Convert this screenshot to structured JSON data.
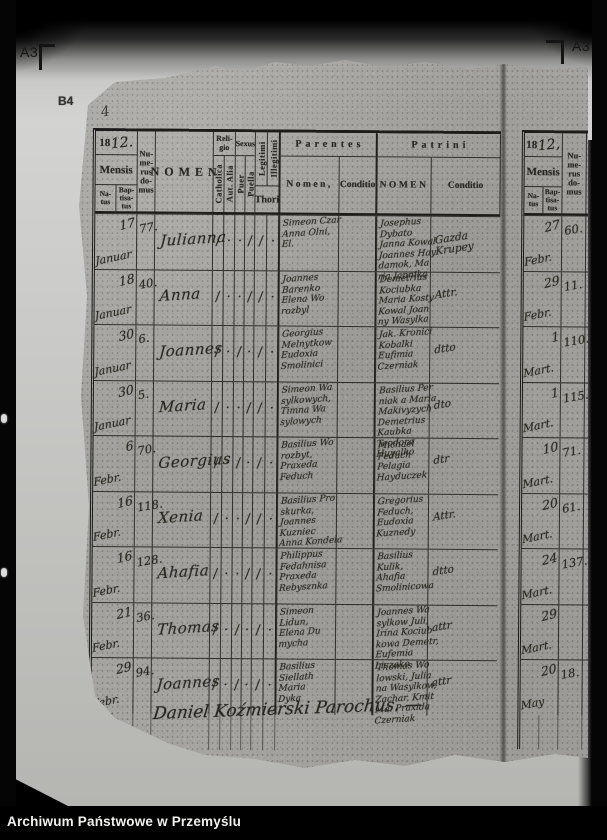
{
  "frame": {
    "label_a3_left": "A3",
    "label_a3_right": "A3",
    "label_b4": "B4",
    "pen_mark": "4",
    "archive_label": "Archiwum Państwowe w Przemyślu"
  },
  "headers": {
    "year_printed": "18",
    "year_script": "12.",
    "year_script_right": "12,",
    "mensis": "Mensis",
    "natus": "Na-\ntus",
    "baptisatus": "Bap-\ntisa-\ntus",
    "numerus_domus": "Nu-\nme-\nrus\ndo-\nmus",
    "nomen": "NOMEN",
    "nomen_partial": "N",
    "religio": "Reli-\ngio",
    "catholica": "Catholica",
    "aut_alia": "Aut. Alia",
    "sexus": "Sexus",
    "puer": "Puer",
    "puella": "Puella",
    "legitimi": "Legitimi",
    "illegitimi": "Illegitimi",
    "thori": "Thori",
    "parentes": "Parentes",
    "parentes_nomen": "Nomen,",
    "conditio": "Conditio",
    "patrini": "Patrini",
    "patrini_nomen": "NOMEN"
  },
  "register": {
    "rows": [
      {
        "day": "17",
        "month": "Januar",
        "domus": "77.",
        "name": "Julianna",
        "marks": [
          "/",
          "·",
          "·",
          "/",
          "/",
          "·"
        ],
        "parentes": "Simeon Czar\nAnna Olni,\nEl.",
        "patrini": "Josephus Dybato\nJanna Kowal\nJoannes Hay\ndamok, Ma\nria Jannika",
        "conditio": "Gazda\nKrupey"
      },
      {
        "day": "18",
        "month": "Januar",
        "domus": "40.",
        "name": "Anna",
        "marks": [
          "/",
          "·",
          "·",
          "/",
          "/",
          "·"
        ],
        "parentes": "Joannes\nBarenko\nElena Wo\nrozbyl",
        "patrini": "Demetrius\nKociubka\nMaria Kosty\nKowal Joan\nny Wasylka",
        "conditio": "Attr."
      },
      {
        "day": "30",
        "month": "Januar",
        "domus": "6.",
        "name": "Joannes",
        "marks": [
          "/",
          "·",
          "/",
          "·",
          "/",
          "·"
        ],
        "parentes": "Georgius\nMelnytkow\nEudoxia\nSmolinici",
        "patrini": "Jak. Kronici\nKobalki\nEufimia\nCzerniak",
        "conditio": "dtto"
      },
      {
        "day": "30",
        "month": "Januar",
        "domus": "5.",
        "name": "Maria",
        "marks": [
          "/",
          "·",
          "·",
          "/",
          "/",
          "·"
        ],
        "parentes": "Simeon Wa\nsylkowych,\nTimna Wa\nsylowych",
        "patrini": "Basilius Per\nniak a Maria\nMakivyzych\nDemetrius Kaubka\nTeodora Huyalko",
        "conditio": "dto"
      },
      {
        "day": "6",
        "month": "Febr.",
        "domus": "70.",
        "name": "Georgius",
        "marks": [
          "/",
          "·",
          "/",
          "·",
          "/",
          "·"
        ],
        "parentes": "Basilius Wo\nrozbyt,\nPraxeda\nFeduch",
        "patrini": "Michael\nFeduch\nPelagia\nHayduczek",
        "conditio": "dtr"
      },
      {
        "day": "16",
        "month": "Febr.",
        "domus": "118.",
        "name": "Xenia",
        "marks": [
          "/",
          "·",
          "·",
          "/",
          "/",
          "·"
        ],
        "parentes": "Basilius Pro\nskurka,\nJoannes Kuzniec\nAnna Kondela",
        "patrini": "Gregorius\nFeduch,\nEudoxia\nKuznedy",
        "conditio": "Attr."
      },
      {
        "day": "16",
        "month": "Febr.",
        "domus": "128.",
        "name": "Ahafia",
        "marks": [
          "/",
          "·",
          "·",
          "/",
          "/",
          "·"
        ],
        "parentes": "Philippus\nFedahnisa\nPraxeda\nRebysznka",
        "patrini": "Basilius\nKulik,\nAhafia\nSmolinicowa",
        "conditio": "dtto"
      },
      {
        "day": "21",
        "month": "Febr.",
        "domus": "36.",
        "name": "Thomas",
        "marks": [
          "/",
          "·",
          "/",
          "·",
          "/",
          "·"
        ],
        "parentes": "Simeon\nLidun,\nElena Du\nmycha",
        "patrini": "Joannes Wa\nsylkow Juli,\nIrina Kociub\nkowa Demetr,\nEufemia Liczako",
        "conditio": "attr"
      },
      {
        "day": "29",
        "month": "Febr.",
        "domus": "94.",
        "name": "Joannes",
        "marks": [
          "/",
          "·",
          "/",
          "·",
          "/",
          "·"
        ],
        "parentes": "Basilius\nSiellath\nMaria\nDyka",
        "patrini": "Thomas Wo\nlowski, Julia\nna Wasylkow,\nZachar. Kmit\nMa. Praxida\nCzerniak",
        "conditio": "attr"
      }
    ],
    "signature": "Daniel Koźmierski Parochus. —"
  },
  "right_page": {
    "rows": [
      {
        "day": "27",
        "month": "Febr.",
        "domus": "60."
      },
      {
        "day": "29",
        "month": "Febr.",
        "domus": "11."
      },
      {
        "day": "1",
        "month": "Mart.",
        "domus": "110."
      },
      {
        "day": "1",
        "month": "Mart.",
        "domus": "115."
      },
      {
        "day": "10",
        "month": "Mart.",
        "domus": "71."
      },
      {
        "day": "20",
        "month": "Mart.",
        "domus": "61."
      },
      {
        "day": "24",
        "month": "Mart.",
        "domus": "137."
      },
      {
        "day": "29",
        "month": "Mart.",
        "domus": ""
      },
      {
        "day": "20",
        "month": "May",
        "domus": "18."
      }
    ]
  }
}
